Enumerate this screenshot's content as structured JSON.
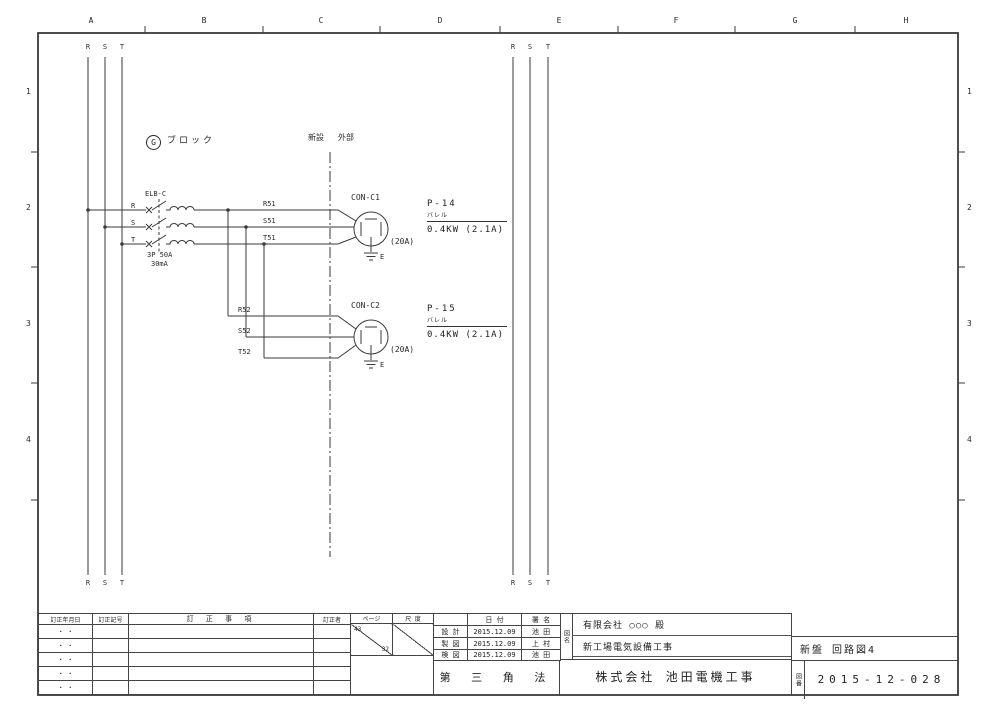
{
  "colors": {
    "line": "#3a3a3a",
    "text": "#222222",
    "paper": "#ffffff"
  },
  "grid": {
    "columns": [
      "A",
      "B",
      "C",
      "D",
      "E",
      "F",
      "G",
      "H"
    ],
    "rows": [
      "1",
      "2",
      "3",
      "4"
    ]
  },
  "schematic": {
    "phase_labels": [
      "R",
      "S",
      "T"
    ],
    "block_tag": {
      "letter": "G",
      "label": "ブロック"
    },
    "boundary": {
      "left": "新設",
      "right": "外部"
    },
    "breaker": {
      "name": "ELB-C",
      "terminals": [
        "R",
        "S",
        "T"
      ],
      "spec_line1": "3P 50A",
      "spec_line2": "30mA"
    },
    "circuits": [
      {
        "wires": [
          "R51",
          "S51",
          "T51"
        ],
        "connector": "CON-C1",
        "rating": "(20A)",
        "earth": "E",
        "load_name": "P-14",
        "load_type": "バレル",
        "load_spec": "0.4KW (2.1A)"
      },
      {
        "wires": [
          "R52",
          "S52",
          "T52"
        ],
        "connector": "CON-C2",
        "rating": "(20A)",
        "earth": "E",
        "load_name": "P-15",
        "load_type": "バレル",
        "load_spec": "0.4KW (2.1A)"
      }
    ]
  },
  "title_block": {
    "revision": {
      "col_date": "訂正年月日",
      "col_code": "訂正記号",
      "col_desc": "訂 正 事 項",
      "col_by": "訂正者",
      "empty_row_mark": "・  ・"
    },
    "page": {
      "label": "ページ",
      "numerator": "43",
      "denominator": "32"
    },
    "scale_label": "尺 度",
    "approval": {
      "date_header": "日 付",
      "sign_header": "署 名",
      "rows": [
        {
          "role": "設 計",
          "date": "2015.12.09",
          "name": "池 田"
        },
        {
          "role": "製 図",
          "date": "2015.12.09",
          "name": "上 村"
        },
        {
          "role": "検 図",
          "date": "2015.12.09",
          "name": "池 田"
        }
      ]
    },
    "projection": "第 三 角 法",
    "name_label_vertical": "図名",
    "client": "有限会社 ○○○ 殿",
    "project": "新工場電気設備工事",
    "company": "株式会社 池田電機工事",
    "sheet": "新盤 回路図4",
    "number_label_vertical": "図番",
    "drawing_number": "2015-12-028"
  }
}
